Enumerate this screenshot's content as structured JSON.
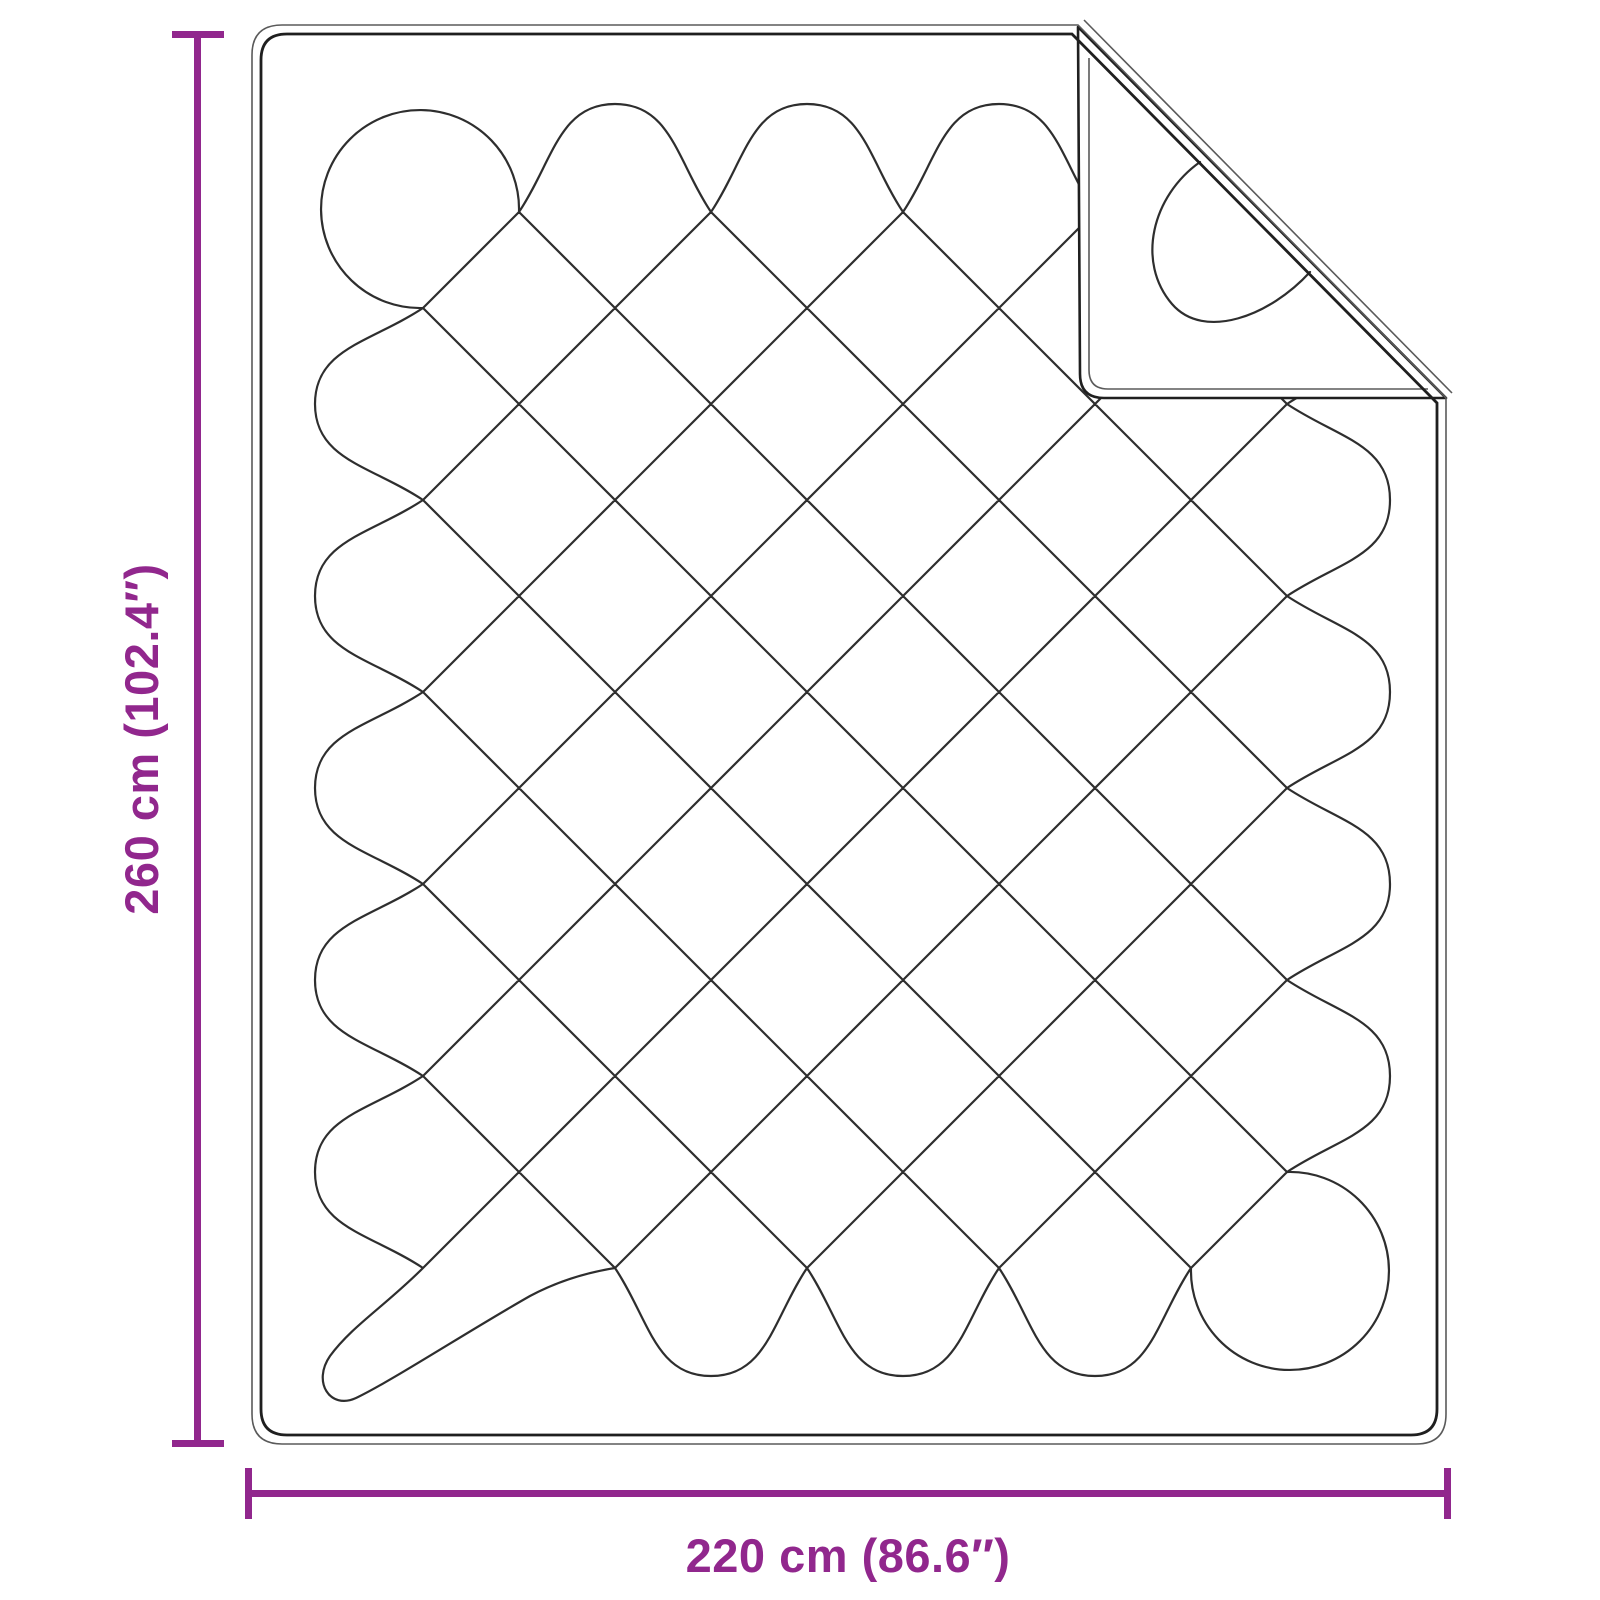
{
  "diagram": {
    "subject": "quilted blanket with diamond stitching and folded top-right corner",
    "height_label": "260 cm (102.4″)",
    "width_label": "220 cm (86.6″)"
  },
  "colors": {
    "dimension": "#91278d",
    "outline": "#1f1f1f",
    "stitch": "#2e2e2e",
    "background": "#ffffff"
  }
}
